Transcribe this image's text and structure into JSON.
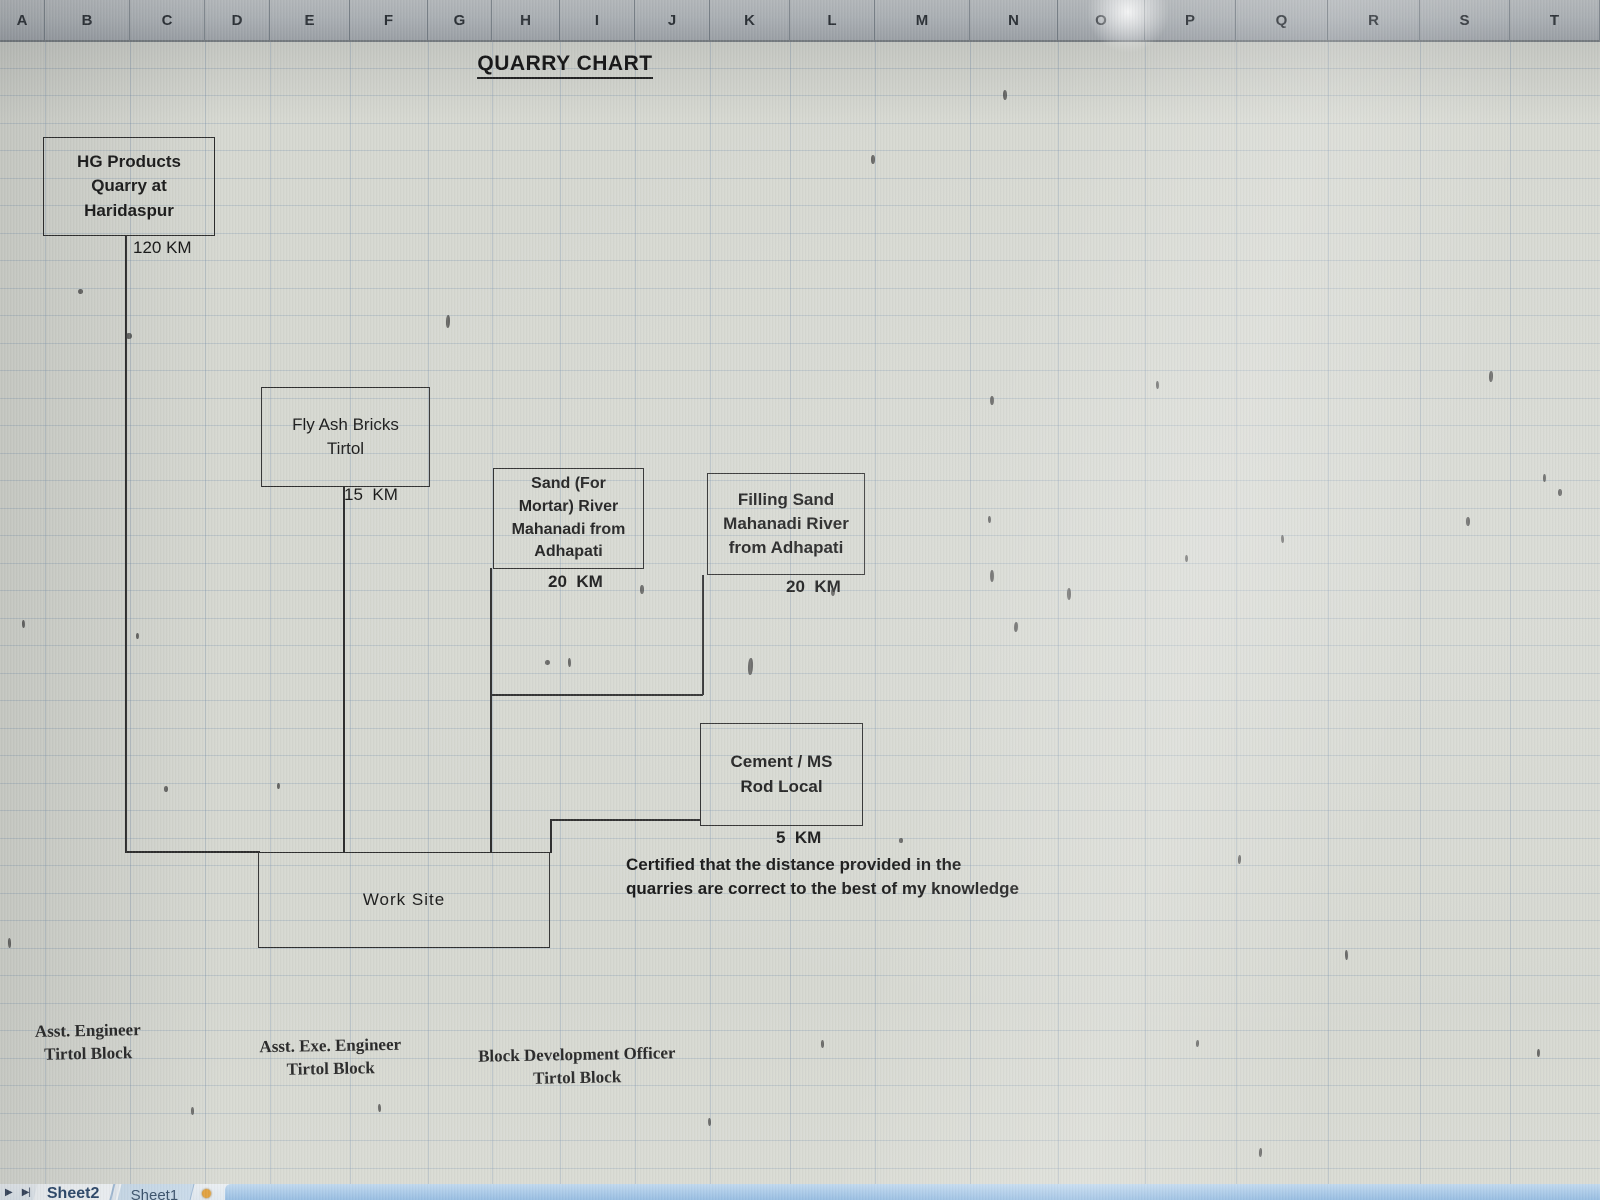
{
  "column_headers": [
    "A",
    "B",
    "C",
    "D",
    "E",
    "F",
    "G",
    "H",
    "I",
    "J",
    "K",
    "L",
    "M",
    "N",
    "O",
    "P",
    "Q",
    "R",
    "S",
    "T"
  ],
  "title": "QUARRY CHART",
  "boxes": {
    "hg": {
      "lines": [
        "HG Products",
        "Quarry at",
        "Haridaspur"
      ]
    },
    "flyash": {
      "lines": [
        "Fly Ash Bricks",
        "Tirtol"
      ]
    },
    "sand": {
      "lines": [
        "Sand (For",
        "Mortar)  River",
        "Mahanadi from",
        "Adhapati"
      ]
    },
    "filling": {
      "lines": [
        "Filling Sand",
        "Mahanadi River",
        "from Adhapati"
      ]
    },
    "cement": {
      "lines": [
        "Cement / MS",
        "Rod Local"
      ]
    },
    "worksite": {
      "lines": [
        "Work Site"
      ]
    }
  },
  "distances": {
    "hg": "120 KM",
    "flyash": "15  KM",
    "sand": "20  KM",
    "filling": "20  KM",
    "cement": "5  KM"
  },
  "certification": "Certified that the distance provided in the quarries are correct to the best of my knowledge",
  "signatures": [
    {
      "title": "Asst. Engineer",
      "org": "Tirtol Block"
    },
    {
      "title": "Asst. Exe. Engineer",
      "org": "Tirtol Block"
    },
    {
      "title": "Block Development Officer",
      "org": "Tirtol Block"
    }
  ],
  "tab_bar": {
    "nav_icons": [
      "▶",
      "▶|"
    ],
    "tabs": [
      {
        "label": "Sheet2",
        "active": true
      },
      {
        "label": "Sheet1",
        "active": false
      }
    ],
    "insert_icon": "insert-worksheet"
  },
  "colors": {
    "cell_background": "#d6d8d1",
    "grid_line": "#aebecb",
    "box_border": "#2e2e2e",
    "header_top": "#cdd1d3",
    "header_bottom": "#a9aeb3",
    "active_tab_text": "#17365d",
    "inactive_tab_bg": "#c7daeb",
    "scroll_strip_blue": "#8fb8e0",
    "insert_icon_orange": "#e09a2f"
  }
}
